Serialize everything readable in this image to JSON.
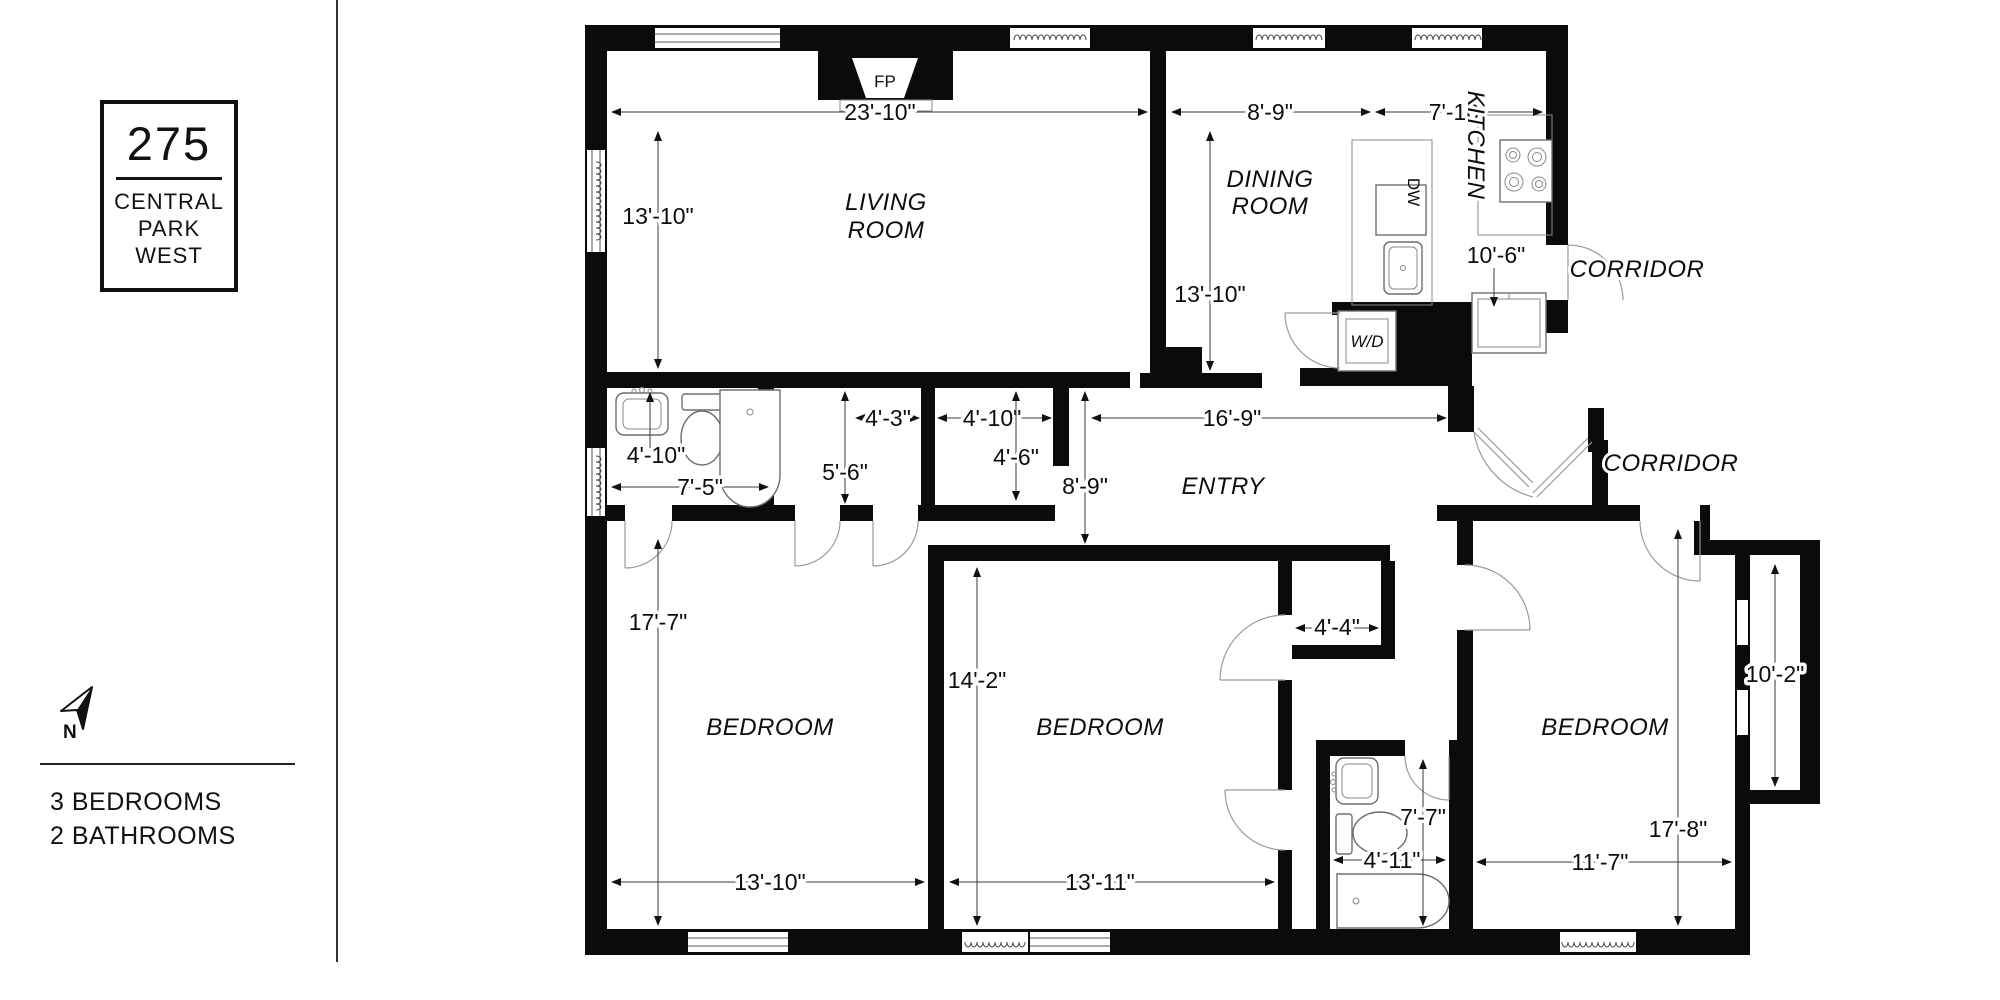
{
  "sidebar": {
    "building_number": "275",
    "address_lines": [
      "CENTRAL",
      "PARK",
      "WEST"
    ],
    "compass_label": "N",
    "summary_lines": [
      "3 BEDROOMS",
      "2 BATHROOMS"
    ]
  },
  "plan": {
    "labels": {
      "living_1": "LIVING",
      "living_2": "ROOM",
      "dining_1": "DINING",
      "dining_2": "ROOM",
      "kitchen": "KITCHEN",
      "corridor_upper": "CORRIDOR",
      "corridor_lower": "CORRIDOR",
      "entry": "ENTRY",
      "bedroom_left": "BEDROOM",
      "bedroom_middle": "BEDROOM",
      "bedroom_right": "BEDROOM"
    },
    "fixtures": {
      "fireplace": "FP",
      "dishwasher": "DW",
      "washer_dryer": "W/D"
    },
    "dims": {
      "living_width": "23'-10\"",
      "living_depth": "13'-10\"",
      "dining_width": "8'-9\"",
      "kitchen_width": "7'-10\"",
      "dining_depth": "13'-10\"",
      "kitchen_depth": "10'-6\"",
      "entry_width": "16'-9\"",
      "entry_depth": "8'-9\"",
      "bath1_depth": "4'-10\"",
      "bath1_width": "7'-5\"",
      "closet_a_depth": "5'-6\"",
      "closet_a_width": "4'-3\"",
      "closet_b_width": "4'-10\"",
      "closet_b_depth": "4'-6\"",
      "bedroom_left_depth": "17'-7\"",
      "bedroom_left_width": "13'-10\"",
      "bedroom_middle_depth": "14'-2\"",
      "bedroom_middle_width": "13'-11\"",
      "closet_c_width": "4'-4\"",
      "bath2_depth": "7'-7\"",
      "bath2_width": "4'-11\"",
      "bedroom_right_width": "11'-7\"",
      "bedroom_right_depth": "17'-8\"",
      "alcove_depth": "10'-2\""
    }
  }
}
